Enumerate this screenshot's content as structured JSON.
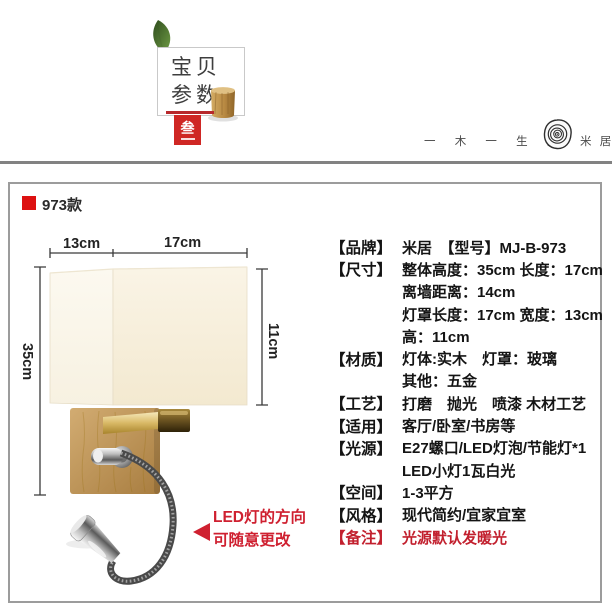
{
  "header": {
    "title_line1": "宝贝",
    "title_line2": "参数",
    "badge_char": "叁",
    "slogan": "一 木 一 生 活",
    "brand": "米 居"
  },
  "panel": {
    "model_label": "973款",
    "dims": {
      "top_left": "13cm",
      "top_right": "17cm",
      "left": "35cm",
      "right": "11cm"
    },
    "note_line1": "LED灯的方向",
    "note_line2": "可随意更改"
  },
  "specs": {
    "rows": [
      {
        "label": "【品牌】",
        "value": "米居　【型号】MJ-B-973"
      },
      {
        "label": "【尺寸】",
        "value": "整体高度：35cm 长度：17cm"
      },
      {
        "label": "",
        "value": "离墙距离：14cm"
      },
      {
        "label": "",
        "value": "灯罩长度：17cm 宽度：13cm"
      },
      {
        "label": "",
        "value": "高：11cm"
      },
      {
        "label": "【材质】",
        "value": "灯体:实木　灯罩：玻璃"
      },
      {
        "label": "",
        "value": "其他：五金"
      },
      {
        "label": "【工艺】",
        "value": "打磨　抛光　喷漆 木材工艺"
      },
      {
        "label": "【适用】",
        "value": "客厅/卧室/书房等"
      },
      {
        "label": "【光源】",
        "value": "E27螺口/LED灯泡/节能灯*1"
      },
      {
        "label": "",
        "value": "LED小灯1瓦白光"
      },
      {
        "label": "【空间】",
        "value": "1-3平方"
      },
      {
        "label": "【风格】",
        "value": "现代简约/宜家宜室"
      },
      {
        "label": "【备注】",
        "value": "光源默认发暖光"
      }
    ]
  },
  "colors": {
    "accent_red": "#dd1111",
    "badge_red": "#cf2724",
    "note_red": "#cf2030",
    "text_dark": "#141414",
    "wood": "#b98d52",
    "shade_cream": "#f7efdc",
    "brass": "#c8a24a",
    "border_gray": "#9c9c9c"
  }
}
